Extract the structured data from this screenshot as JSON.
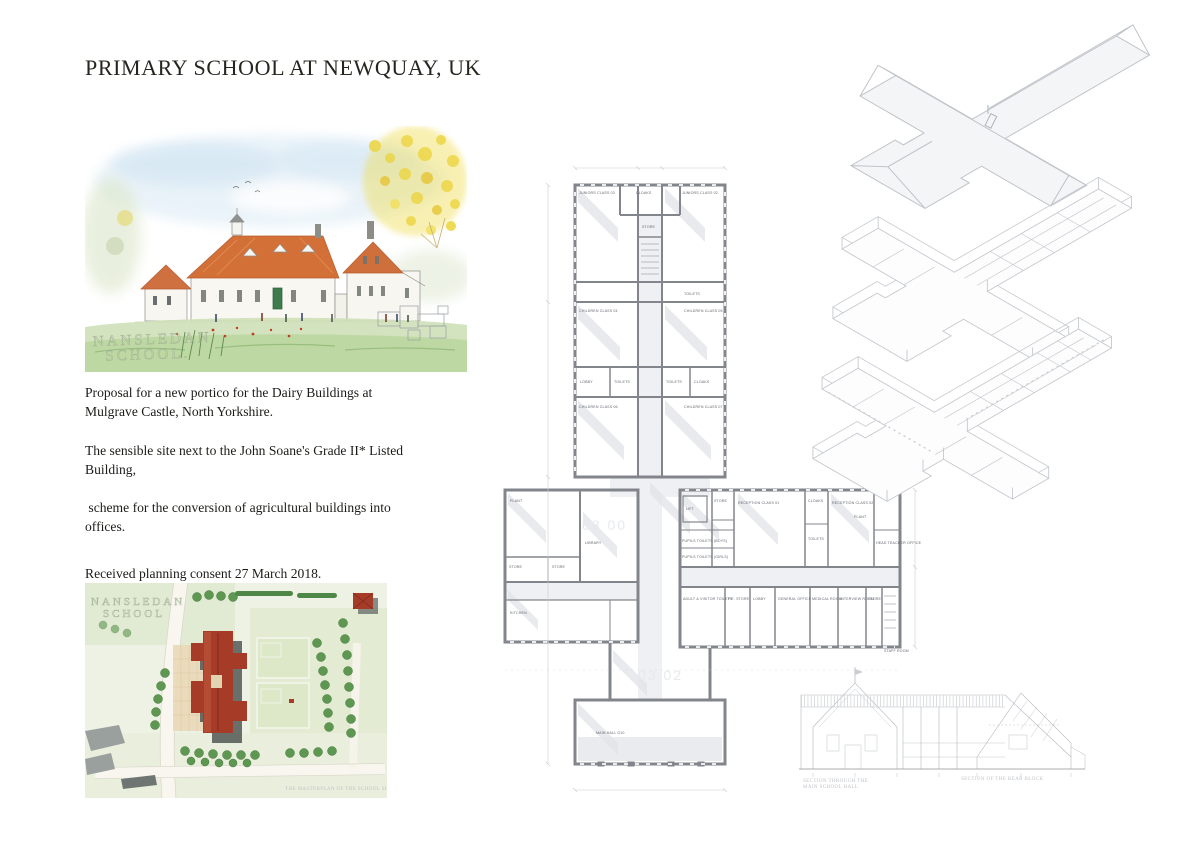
{
  "page": {
    "title": "PRIMARY SCHOOL AT NEWQUAY, UK"
  },
  "intro": {
    "para1": "Proposal for a new portico for the Dairy Buildings at Mulgrave Castle, North Yorkshire.",
    "para2": "The sensible site next to the John Soane's Grade II* Listed Building,",
    "para3": " scheme for the conversion of agricultural buildings into offices.",
    "consent": "Received planning consent 27 March 2018."
  },
  "perspective": {
    "watermark_line1": "NANSLEDAN",
    "watermark_line2": "SCHOOL."
  },
  "site_plan": {
    "watermark_line1": "NANSLEDAN",
    "watermark_line2": "SCHOOL",
    "caption": "THE MASTERPLAN OF THE SCHOOL SITE"
  },
  "floor_plan": {
    "ghost_text1": "08 00",
    "ghost_text2": "03 02",
    "rooms": [
      "JUNIORS CLASS 03",
      "CLOAKS",
      "JUNIORS CLASS 02",
      "STORE",
      "TOILETS",
      "CHILDREN CLASS 04",
      "CHILDREN CLASS 05",
      "LOBBY",
      "TOILETS",
      "TOILETS",
      "CLOAKS",
      "CHILDREN CLASS 06",
      "CHILDREN CLASS 07",
      "PLANT",
      "LIBRARY",
      "STORE",
      "STORE",
      "KITCHEN",
      "LIFT",
      "STORE",
      "RECEPTION CLASS 01",
      "PUPILS TOILETS (BOYS)",
      "PUPILS TOILETS (GIRLS)",
      "CLOAKS",
      "RECEPTION CLASS 02",
      "TOILETS",
      "PLANT",
      "HEAD TEACHER OFFICE",
      "ADULT & VISITOR TOILETS",
      "P.E. STORE",
      "LOBBY",
      "GENERAL OFFICE",
      "MEDICAL ROOM",
      "INTERVIEW ROOM",
      "STORE",
      "STAFF ROOM",
      "MAIN HALL G10"
    ]
  },
  "sections": {
    "caption_left_line1": "SECTION THROUGH THE",
    "caption_left_line2": "MAIN SCHOOL HALL",
    "caption_right": "SECTION OF THE REAR BLOCK"
  },
  "colors": {
    "roof_orange": "#d27038",
    "site_building_red": "#a63b28",
    "plan_wall_grey": "#82868c",
    "axon_line_grey": "#c3c7cc",
    "text_black": "#1c1b18"
  }
}
